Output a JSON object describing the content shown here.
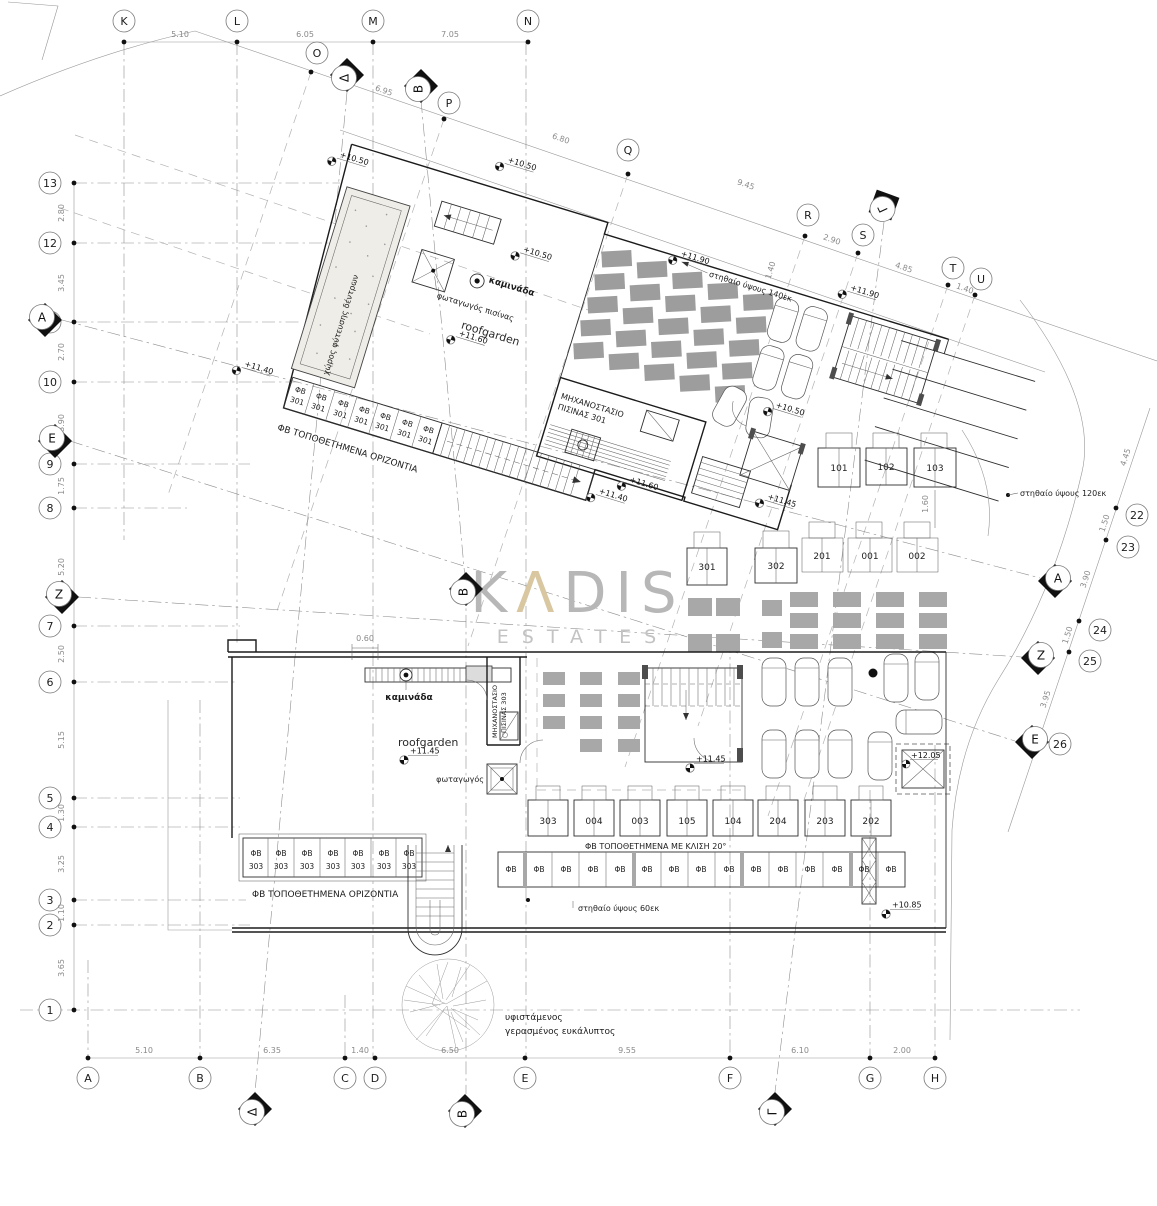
{
  "watermark": {
    "k": "K",
    "a": "Λ",
    "rest": "DIS",
    "subtitle": "ESTATES"
  },
  "axes": {
    "top": {
      "labels": [
        "K",
        "L",
        "M",
        "N"
      ],
      "dims": [
        "5.10",
        "6.05",
        "7.05"
      ]
    },
    "diagonal": {
      "labels": [
        "O",
        "P",
        "Q",
        "R",
        "S",
        "T",
        "U"
      ],
      "dims": [
        "6.95",
        "6.80",
        "9.45",
        "2.90",
        "4.85",
        "1.40"
      ]
    },
    "left": {
      "labels": [
        "13",
        "12",
        "11",
        "10",
        "9",
        "8",
        "7",
        "6",
        "5",
        "4",
        "3",
        "2",
        "1"
      ],
      "dims": [
        "2.80",
        "3.45",
        "2.70",
        "3.90",
        "1.75",
        "5.20",
        "2.50",
        "5.15",
        "1.30",
        "3.25",
        "1.10",
        "3.65"
      ]
    },
    "right": {
      "labels": [
        "22",
        "23",
        "24",
        "25",
        "26"
      ],
      "dims": [
        "4.45",
        "1.50",
        "3.90",
        "1.50",
        "3.95"
      ]
    },
    "bottom": {
      "labels": [
        "A",
        "B",
        "C",
        "D",
        "E",
        "F",
        "G",
        "H"
      ],
      "dims": [
        "5.10",
        "6.35",
        "1.40",
        "6.50",
        "9.55",
        "6.10",
        "2.00"
      ]
    }
  },
  "sections": {
    "delta": "Δ",
    "beta": "Β",
    "gamma": "Γ",
    "alpha": "Α",
    "zeta": "Ζ",
    "epsilon": "Ε"
  },
  "labels": {
    "roofgarden": "roofgarden",
    "chimney": "καμινάδα",
    "lightwell": "φωταγωγός",
    "lightwell_pool": "φωταγωγός πισίνας",
    "planting": "χώρος φύτευσης δέντρων",
    "plantroom_301_l1": "ΜΗΧΑΝΟΣΤΑΣΙΟ",
    "plantroom_301_l2": "ΠΙΣΙΝΑΣ 301",
    "plantroom_303_l1": "ΜΗΧΑΝΟΣΤΑΣΙΟ",
    "plantroom_303_l2": "ΠΙΣΙΝΑΣ 303",
    "pv_horizontal": "ΦΒ ΤΟΠΟΘΕΤΗΜΕΝΑ ΟΡΙΖΟΝΤΙΑ",
    "pv_tilted": "ΦΒ ΤΟΠΟΘΕΤΗΜΕΝΑ ΜΕ ΚΛΙΣΗ 20°",
    "parapet_140": "στηθαίο ύψους 140εκ",
    "parapet_120": "στηθαίο ύψους 120εκ",
    "parapet_60": "στηθαίο ύψους 60εκ",
    "tree_l1": "υφιστάμενος",
    "tree_l2": "γερασμένος ευκάλυπτος",
    "pv": "ΦΒ",
    "pv_301": "301",
    "pv_303": "303",
    "dim_060": "0.60",
    "dim_140": "1.40",
    "dim_160": "1.60"
  },
  "elevations": {
    "e_1050": "+10.50",
    "e_1085": "+10.85",
    "e_1140": "+11.40",
    "e_1145": "+11.45",
    "e_1160": "+11.60",
    "e_1190": "+11.90",
    "e_1205": "+12.05"
  },
  "storages": {
    "upper": [
      "101",
      "102",
      "103"
    ],
    "mid": [
      "301",
      "302",
      "201",
      "001",
      "002"
    ],
    "lower": [
      "303",
      "004",
      "003",
      "105",
      "104",
      "204",
      "203",
      "202"
    ]
  }
}
